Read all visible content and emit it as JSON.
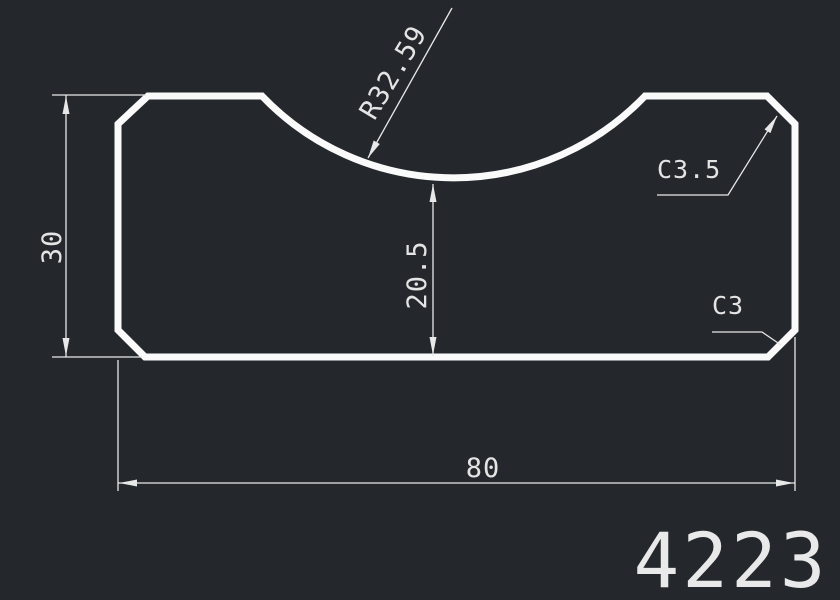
{
  "title": "CAD profile drawing",
  "canvas": {
    "background_color": "#24282c",
    "outline_color": "#fafafa",
    "dimension_color": "#e8e8e8"
  },
  "labels": {
    "height": "30",
    "notch_height": "20.5",
    "width": "80",
    "radius": "R32.59",
    "chamfer_top_right": "C3.5",
    "chamfer_bottom_right": "C3",
    "part_number": "4223"
  }
}
